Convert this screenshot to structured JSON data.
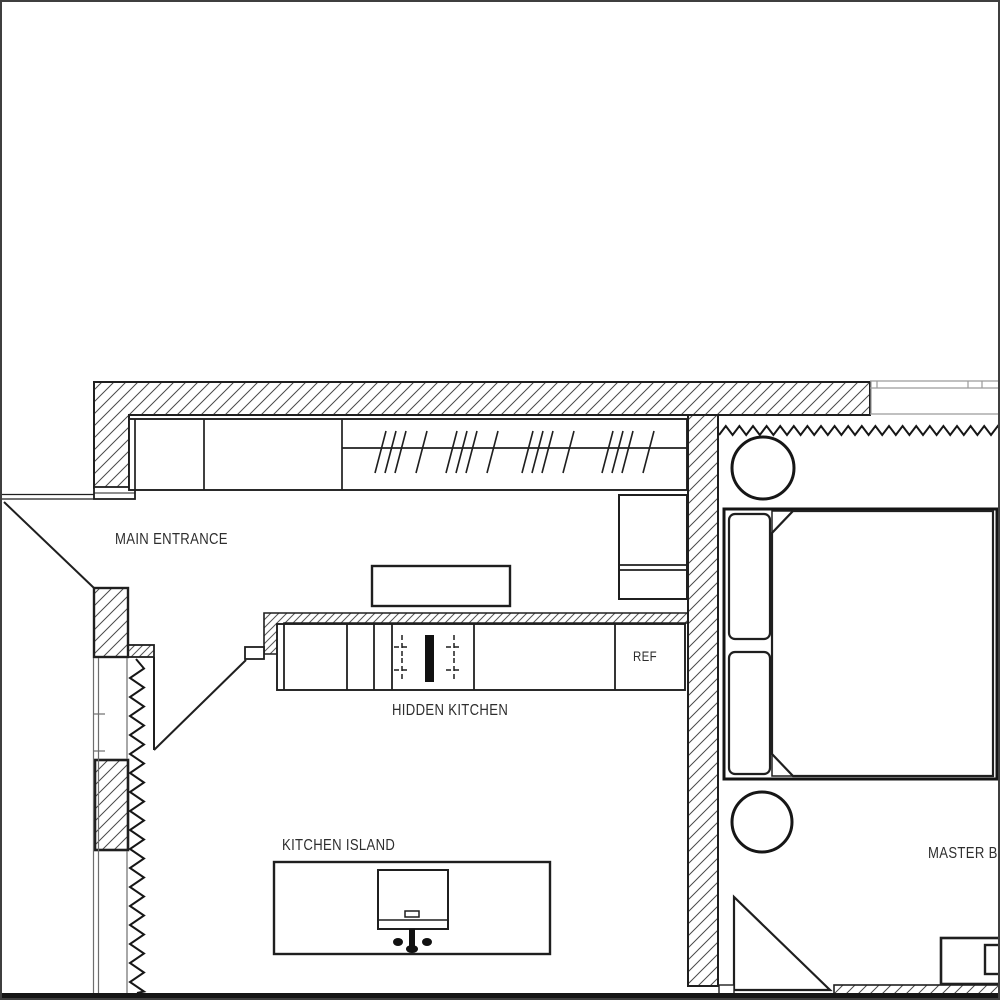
{
  "plan": {
    "labels": {
      "main_entrance": "MAIN ENTRANCE",
      "hidden_kitchen": "HIDDEN KITCHEN",
      "kitchen_island": "KITCHEN ISLAND",
      "refrigerator": "REF",
      "master_bedroom": "MASTER BEDROOM"
    },
    "colors": {
      "line": "#1f1f1f",
      "background": "#ffffff"
    }
  }
}
